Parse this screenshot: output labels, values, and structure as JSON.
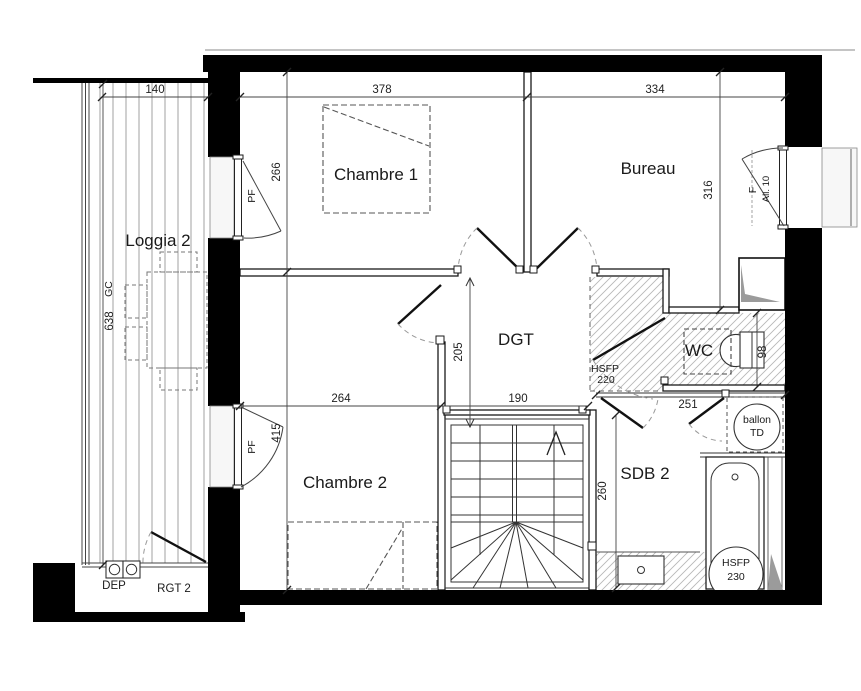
{
  "plan": {
    "rooms": {
      "loggia2": "Loggia 2",
      "chambre1": "Chambre 1",
      "bureau": "Bureau",
      "dgt": "DGT",
      "wc": "WC",
      "chambre2": "Chambre 2",
      "sdb2": "SDB 2",
      "rgt2": "RGT 2"
    },
    "dims": {
      "loggia_w": "140",
      "ch1_w": "378",
      "bureau_w": "334",
      "ch1_h": "266",
      "bureau_h": "316",
      "loggia_h": "638",
      "dgt_h": "205",
      "ch2_w": "264",
      "stair_w": "190",
      "sdb_top_w": "251",
      "ch2_h": "415",
      "sdb2_h": "260",
      "wc_h": "98"
    },
    "annot": {
      "pf_top": "PF",
      "pf_bottom": "PF",
      "window_f": "F",
      "window_all": "All. 10",
      "gc": "GC",
      "dep": "DEP",
      "hsfp220_l1": "HSFP",
      "hsfp220_l2": "220",
      "hsfp230_l1": "HSFP",
      "hsfp230_l2": "230",
      "ballon_l1": "ballon",
      "ballon_l2": "TD"
    }
  }
}
